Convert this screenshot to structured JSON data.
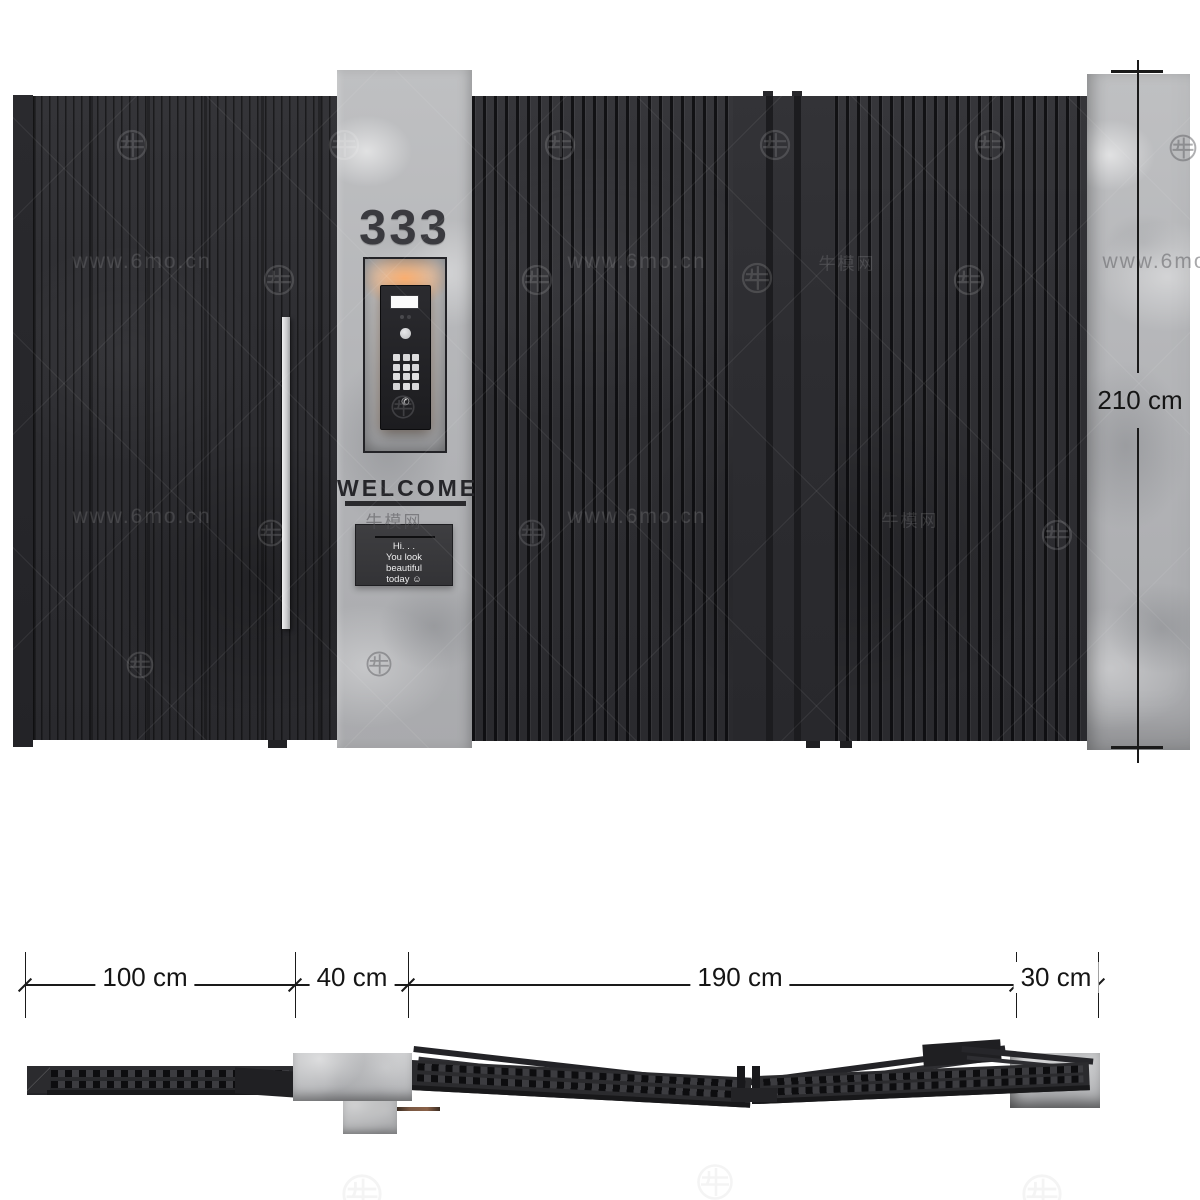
{
  "watermark": {
    "url_text": "www.6mo.cn",
    "cn_text": "牛模网",
    "logo_name": "niumo-circle-logo",
    "items": [
      {
        "t": "logo-light",
        "x": 115,
        "y": 128
      },
      {
        "t": "logo-light",
        "x": 327,
        "y": 128
      },
      {
        "t": "logo-light",
        "x": 543,
        "y": 128
      },
      {
        "t": "logo-light",
        "x": 758,
        "y": 128
      },
      {
        "t": "logo-light",
        "x": 973,
        "y": 128
      },
      {
        "t": "logo-dark",
        "x": 1168,
        "y": 133,
        "s": 30
      },
      {
        "t": "url-light",
        "x": 142,
        "y": 262
      },
      {
        "t": "logo-light",
        "x": 262,
        "y": 263
      },
      {
        "t": "logo-light",
        "x": 520,
        "y": 263
      },
      {
        "t": "url-light",
        "x": 637,
        "y": 262
      },
      {
        "t": "logo-light",
        "x": 740,
        "y": 261
      },
      {
        "t": "cn-light",
        "x": 847,
        "y": 262
      },
      {
        "t": "logo-light",
        "x": 952,
        "y": 263
      },
      {
        "t": "url-dark",
        "x": 1172,
        "y": 262
      },
      {
        "t": "logo-dark",
        "x": 390,
        "y": 394,
        "s": 26
      },
      {
        "t": "url-light",
        "x": 142,
        "y": 517
      },
      {
        "t": "logo-light",
        "x": 256,
        "y": 518,
        "s": 30
      },
      {
        "t": "cn-dark",
        "x": 394,
        "y": 520
      },
      {
        "t": "logo-dark",
        "x": 517,
        "y": 518,
        "s": 30
      },
      {
        "t": "url-light",
        "x": 637,
        "y": 517
      },
      {
        "t": "cn-light",
        "x": 910,
        "y": 519
      },
      {
        "t": "logo-light",
        "x": 1040,
        "y": 518
      },
      {
        "t": "logo-light",
        "x": 125,
        "y": 650,
        "s": 30
      },
      {
        "t": "logo-dark",
        "x": 365,
        "y": 650,
        "s": 28
      },
      {
        "t": "logo-faint",
        "x": 340,
        "y": 1172,
        "s": 44
      },
      {
        "t": "logo-faint",
        "x": 695,
        "y": 1162,
        "s": 40
      },
      {
        "t": "logo-faint",
        "x": 1020,
        "y": 1172,
        "s": 44
      }
    ]
  },
  "front": {
    "house_number": "333",
    "welcome": "WELCOME",
    "intercom_sign": {
      "lines": [
        "Hi. . .",
        "You look",
        "beautiful",
        "today ☺"
      ]
    },
    "height_label": "210 cm"
  },
  "bottom_dims": {
    "labels": [
      {
        "text": "100 cm",
        "x": 145
      },
      {
        "text": "40 cm",
        "x": 352
      },
      {
        "text": "190 cm",
        "x": 740
      },
      {
        "text": "30 cm",
        "x": 1056
      }
    ],
    "ticks": [
      25,
      295,
      408,
      1016,
      1098
    ]
  },
  "colors": {
    "panel": "#2e2e32",
    "concrete": "#b4b5b8",
    "glow": "#f2a968",
    "copper": "#6e4f3e",
    "dimension": "#1a1a1a"
  }
}
